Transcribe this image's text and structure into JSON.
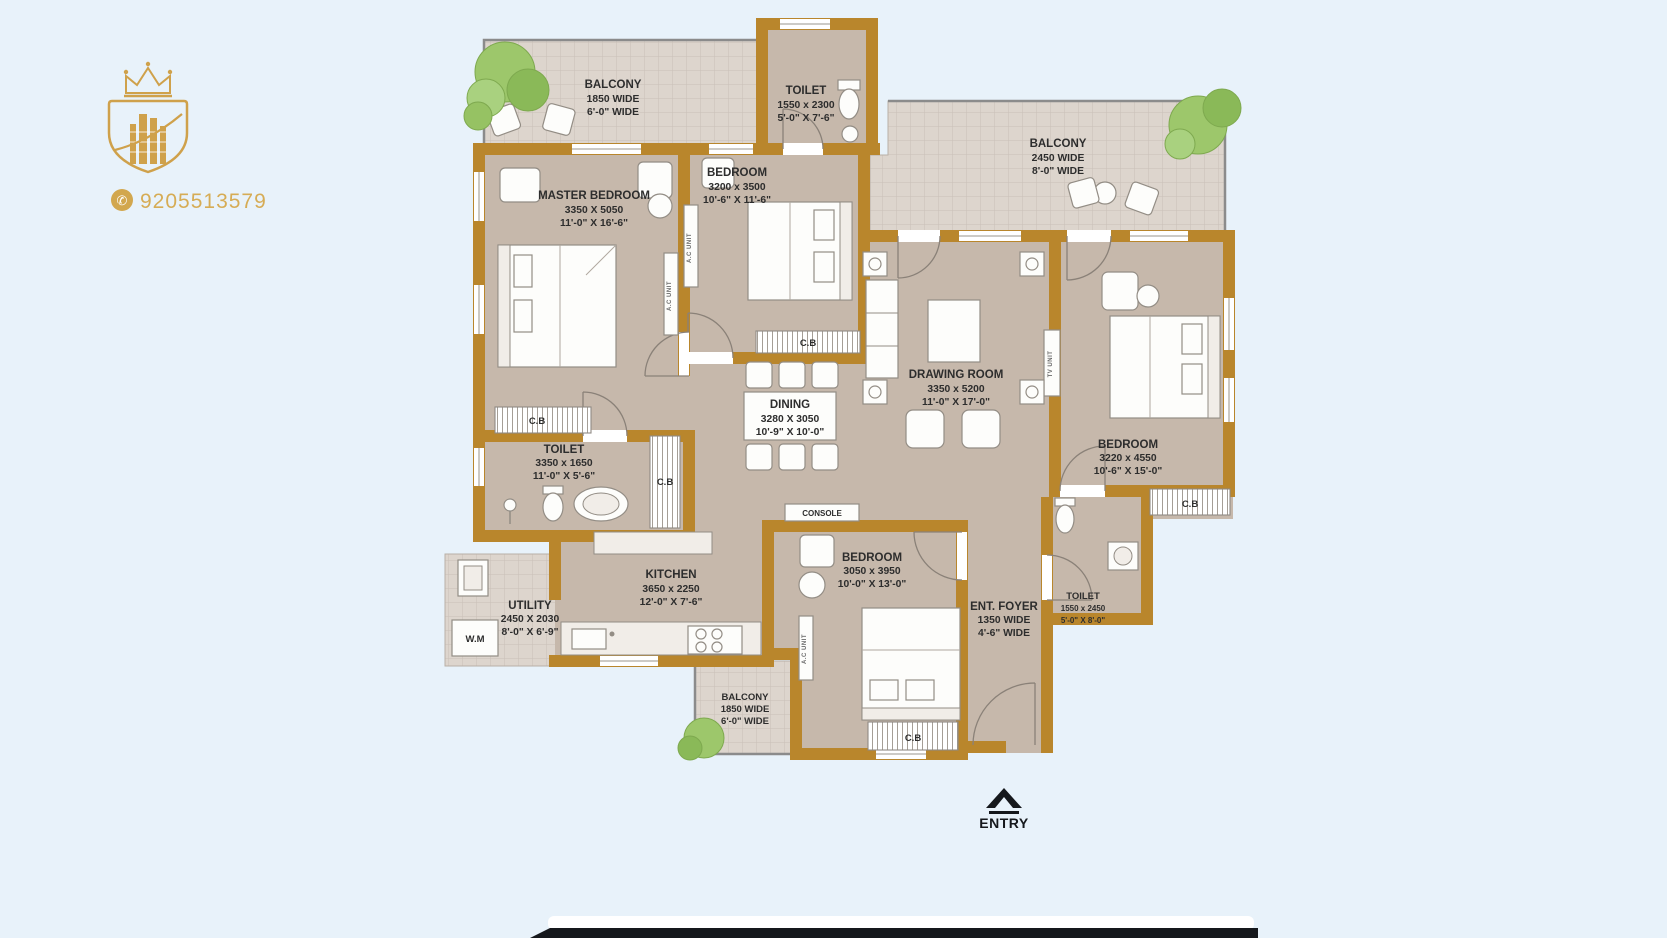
{
  "brand": {
    "phone": "9205513579"
  },
  "plan": {
    "rooms": [
      {
        "id": "balcony-top-left",
        "name": "BALCONY",
        "metric": "1850 WIDE",
        "imperial": "6'-0\" WIDE"
      },
      {
        "id": "toilet-top",
        "name": "TOILET",
        "metric": "1550 x 2300",
        "imperial": "5'-0\" X 7'-6\""
      },
      {
        "id": "master-bedroom",
        "name": "MASTER BEDROOM",
        "metric": "3350 X 5050",
        "imperial": "11'-0\" X 16'-6\""
      },
      {
        "id": "bedroom-top",
        "name": "BEDROOM",
        "metric": "3200 x 3500",
        "imperial": "10'-6\" X 11'-6\""
      },
      {
        "id": "balcony-top-right",
        "name": "BALCONY",
        "metric": "2450 WIDE",
        "imperial": "8'-0\" WIDE"
      },
      {
        "id": "drawing-room",
        "name": "DRAWING ROOM",
        "metric": "3350 x 5200",
        "imperial": "11'-0\" X 17'-0\""
      },
      {
        "id": "dining",
        "name": "DINING",
        "metric": "3280 X 3050",
        "imperial": "10'-9\" X 10'-0\""
      },
      {
        "id": "bedroom-right",
        "name": "BEDROOM",
        "metric": "3220 x 4550",
        "imperial": "10'-6\" X 15'-0\""
      },
      {
        "id": "toilet-master",
        "name": "TOILET",
        "metric": "3350 x 1650",
        "imperial": "11'-0\" X 5'-6\""
      },
      {
        "id": "kitchen",
        "name": "KITCHEN",
        "metric": "3650 x 2250",
        "imperial": "12'-0\" X 7'-6\""
      },
      {
        "id": "utility",
        "name": "UTILITY",
        "metric": "2450 X 2030",
        "imperial": "8'-0\" X 6'-9\""
      },
      {
        "id": "bedroom-bottom",
        "name": "BEDROOM",
        "metric": "3050 x 3950",
        "imperial": "10'-0\" X 13'-0\""
      },
      {
        "id": "ent-foyer",
        "name": "ENT. FOYER",
        "metric": "1350 WIDE",
        "imperial": "4'-6\" WIDE"
      },
      {
        "id": "toilet-bottom",
        "name": "TOILET",
        "metric": "1550 x 2450",
        "imperial": "5'-0\" X 8'-0\""
      },
      {
        "id": "balcony-bottom",
        "name": "BALCONY",
        "metric": "1850 WIDE",
        "imperial": "6'-0\" WIDE"
      }
    ],
    "annotations": {
      "cupboard": "C.B",
      "console": "CONSOLE",
      "washing_machine": "W.M",
      "entry": "ENTRY",
      "ac_unit": "A.C UNIT",
      "tv_unit": "TV UNIT"
    }
  },
  "colors": {
    "background": "#e8f2fa",
    "wall": "#b9862c",
    "floor": "#c6b8ab",
    "tile": "#ddd5cd",
    "brand_gold": "#cfa14b",
    "label_text": "#2d2d2d",
    "bottom_bar": "#15181c"
  }
}
